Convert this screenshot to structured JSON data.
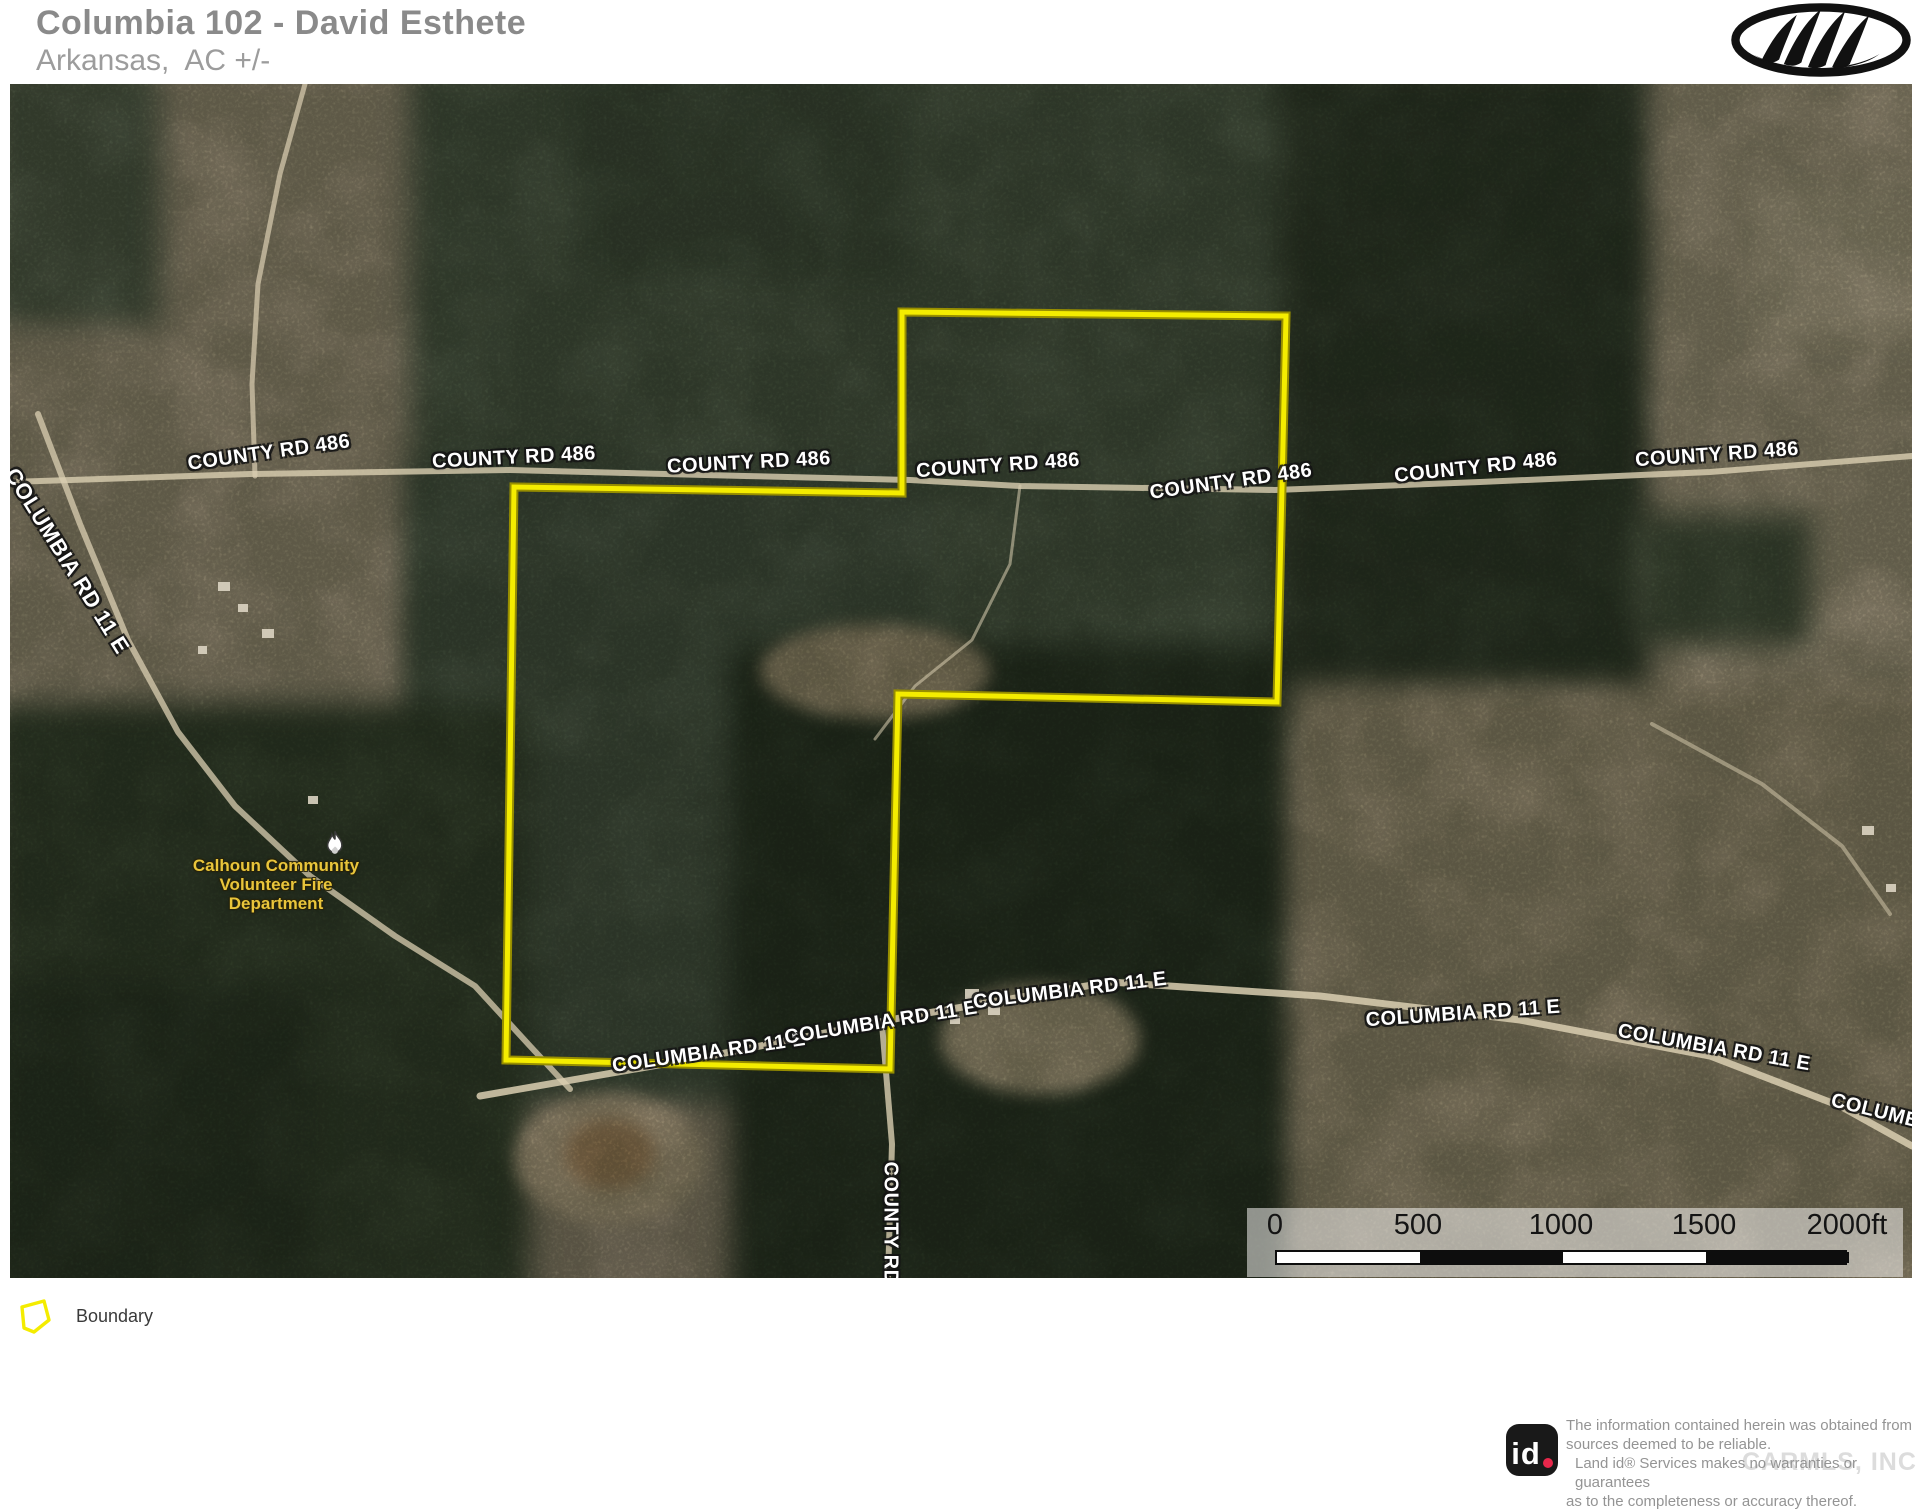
{
  "header": {
    "title": "Columbia 102 - David Esthete",
    "subtitle": "Arkansas,  AC +/-"
  },
  "colors": {
    "boundary": "#f4ec00",
    "boundary_outline": "#978e00",
    "road": "#dbcfb2",
    "road_label_text": "#ffffff",
    "poi_text": "#e9c53b",
    "scale_text": "#141414",
    "brand_black": "#111111",
    "id_logo_red": "#e8274b",
    "title_gray": "#8a8a8a"
  },
  "map": {
    "boundary": {
      "points": "892,228 1276,232 1267,618 888,610 880,985 496,976 504,403 892,409"
    },
    "road_labels": [
      {
        "text": "COUNTY RD 486",
        "x": 259,
        "y": 369,
        "rot": -8
      },
      {
        "text": "COUNTY RD 486",
        "x": 504,
        "y": 374,
        "rot": -3
      },
      {
        "text": "COUNTY RD 486",
        "x": 739,
        "y": 379,
        "rot": -3
      },
      {
        "text": "COUNTY RD 486",
        "x": 988,
        "y": 382,
        "rot": -4
      },
      {
        "text": "COUNTY RD 486",
        "x": 1221,
        "y": 398,
        "rot": -8
      },
      {
        "text": "COUNTY RD 486",
        "x": 1466,
        "y": 384,
        "rot": -6
      },
      {
        "text": "COUNTY RD 486",
        "x": 1707,
        "y": 371,
        "rot": -4
      },
      {
        "text": "COLUMBIA RD 11 E",
        "x": 699,
        "y": 969,
        "rot": -8
      },
      {
        "text": "COLUMBIA RD 11 E",
        "x": 871,
        "y": 939,
        "rot": -9
      },
      {
        "text": "COLUMBIA RD 11 E",
        "x": 1060,
        "y": 907,
        "rot": -7
      },
      {
        "text": "COLUMBIA RD 11 E",
        "x": 1453,
        "y": 930,
        "rot": -4
      },
      {
        "text": "COLUMBIA RD 11 E",
        "x": 1704,
        "y": 964,
        "rot": 10
      },
      {
        "text": "COLUMBIA RD 11 E",
        "x": 1916,
        "y": 1040,
        "rot": 14
      },
      {
        "text": "COLUMBIA RD 11 E",
        "x": 57,
        "y": 477,
        "rot": 58,
        "cls": "vertical-left"
      },
      {
        "text": "COUNTY RD",
        "x": 880,
        "y": 1139,
        "rot": 90
      }
    ],
    "roads": [
      {
        "points": "0,398 240,390 500,386 735,392 900,396 1010,402 1265,406 1470,398 1700,388 1902,372",
        "w": 6,
        "opacity": 0.8
      },
      {
        "points": "295,0 270,90 248,200 242,300 245,392",
        "w": 5,
        "opacity": 0.7
      },
      {
        "points": "28,330 70,440 118,556 168,648 225,722 300,792 385,852 465,902 520,962 560,1005",
        "w": 6,
        "opacity": 0.75
      },
      {
        "points": "470,1012 700,972 900,932 1100,898 1310,912 1510,936 1700,972 1830,1022 1902,1062",
        "w": 7,
        "opacity": 0.85
      },
      {
        "points": "872,940 882,1060 878,1194",
        "w": 6,
        "opacity": 0.8
      },
      {
        "points": "1010,402 1000,480 962,556 905,602 865,655",
        "w": 3,
        "opacity": 0.55
      },
      {
        "points": "1642,640 1752,700 1832,762 1880,830",
        "w": 4,
        "opacity": 0.5
      }
    ],
    "structures": [
      {
        "x": 208,
        "y": 498,
        "w": 12,
        "h": 9
      },
      {
        "x": 228,
        "y": 520,
        "w": 10,
        "h": 8
      },
      {
        "x": 252,
        "y": 545,
        "w": 12,
        "h": 9
      },
      {
        "x": 188,
        "y": 562,
        "w": 9,
        "h": 8
      },
      {
        "x": 298,
        "y": 712,
        "w": 10,
        "h": 8
      },
      {
        "x": 955,
        "y": 905,
        "w": 14,
        "h": 10
      },
      {
        "x": 978,
        "y": 922,
        "w": 12,
        "h": 9
      },
      {
        "x": 940,
        "y": 932,
        "w": 10,
        "h": 8
      },
      {
        "x": 1852,
        "y": 742,
        "w": 12,
        "h": 9
      },
      {
        "x": 1876,
        "y": 800,
        "w": 10,
        "h": 8
      }
    ],
    "poi": {
      "icon": "fire-icon",
      "lines": [
        "Calhoun Community",
        "Volunteer Fire",
        "Department"
      ]
    },
    "scale": {
      "ticks": [
        {
          "label": "0",
          "x": 28
        },
        {
          "label": "500",
          "x": 171
        },
        {
          "label": "1000",
          "x": 314
        },
        {
          "label": "1500",
          "x": 457
        },
        {
          "label": "2000ft",
          "x": 600
        }
      ],
      "segment_px": 143,
      "bar_left": 28
    }
  },
  "legend": {
    "items": [
      {
        "label": "Boundary"
      }
    ]
  },
  "footer": {
    "logo_text": "id",
    "watermark": "CARMLS, INC",
    "disclaimer_lines": [
      "The information contained herein was obtained from",
      "sources deemed to be reliable.",
      "Land id® Services makes no warranties or guarantees",
      "as to the completeness or accuracy thereof."
    ]
  }
}
